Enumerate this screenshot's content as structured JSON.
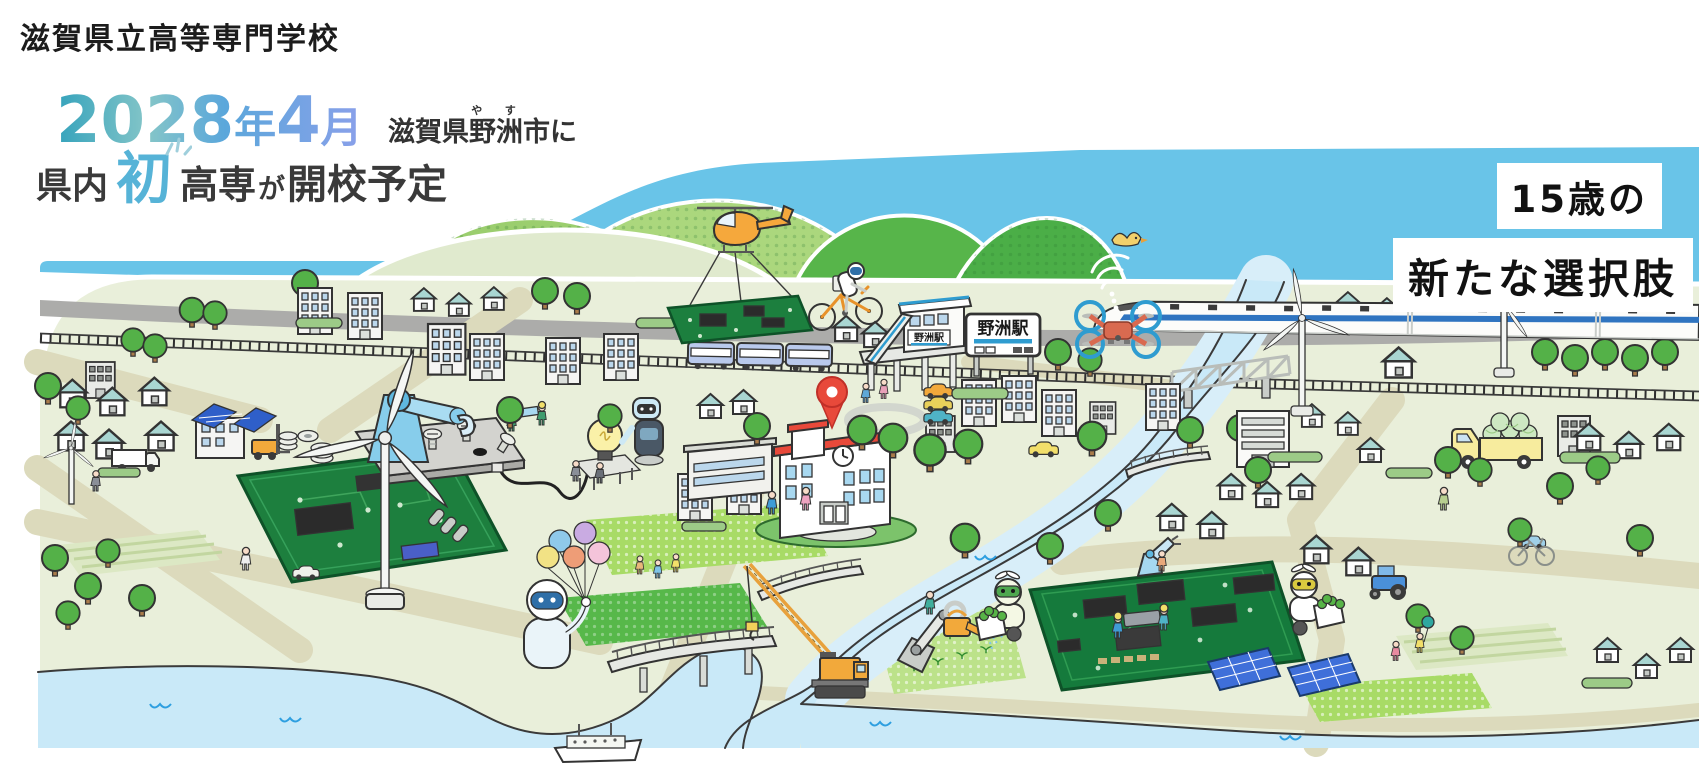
{
  "header": {
    "site_title": "滋賀県立高等専門学校",
    "headline": {
      "date_digits_year": "2028",
      "date_unit_year": "年",
      "date_digit_month": "4",
      "date_unit_month": "月",
      "location_prefix": "滋賀県",
      "location_ruby_base": "野洲",
      "location_ruby_reading": "や す",
      "location_suffix": "市に",
      "line2_prefix": "県内",
      "line2_highlight": "初",
      "line2_word": "高専",
      "line2_particle": "が",
      "line2_rest": "開校予定"
    },
    "tagline_line1": "15歳の",
    "tagline_line2": "新たな選択肢"
  },
  "map": {
    "station_signboard_text": "野洲駅",
    "station_building_sign_text": "野洲駅"
  },
  "palette": {
    "sky": "#69C4E8",
    "land": "#E9EFDA",
    "road": "#DCDABC",
    "gray_track": "#ACACAA",
    "hill_light": "#9BCE6E",
    "hill_mid": "#ABD77D",
    "hill_dark": "#57B54A",
    "hill_pale": "#E0EACE",
    "water": "#C9E9F8",
    "pcb_green": "#1D7F3E",
    "roof_teal": "#A9D6D2",
    "school_red": "#E8493A",
    "pin_red": "#E8493A",
    "crane_orange": "#F2A93B",
    "drone_red": "#D96A50",
    "rotor_blue": "#2F9CD0",
    "shinkansen_stripe": "#2F74C0",
    "date_gradient_start": "#35A3BC",
    "date_gradient_end": "#8AA0EA",
    "hatsu_blue": "#56B3D7"
  },
  "illustration_elements": [
    "sky",
    "hills",
    "land",
    "railway",
    "gray-track",
    "roads",
    "lake",
    "river",
    "riverside-road",
    "pedestrian-bridge",
    "upper-bridge",
    "small-bridge",
    "truss-bridge",
    "ferry",
    "crane",
    "pcb-field-left",
    "pcb-field-right",
    "seedling-field",
    "striped-fields",
    "dotted-fields",
    "school-building",
    "map-pin-icon",
    "yasu-station",
    "station-signboard",
    "warehouse",
    "solar-roof-building",
    "offices",
    "houses",
    "trees",
    "bushes",
    "people",
    "wind-turbine-large",
    "wind-turbine-right-1",
    "wind-turbine-right-2",
    "wind-turbine-small",
    "robot-arm-factory",
    "bolt-plate",
    "nut-stacks",
    "light-bulb",
    "humanoid-robot",
    "balloon-robot",
    "watering-robot-arm",
    "harvest-robot-green",
    "harvest-robot-yellow",
    "pcb-workers",
    "small-pcb-arm",
    "solar-panels",
    "melon-truck",
    "white-truck",
    "forklift",
    "tractor",
    "mini-cars",
    "parked-cars",
    "bicycle",
    "local-train",
    "shinkansen",
    "helicopter",
    "slung-pcb",
    "cycling-robot",
    "drone",
    "wifi-signal-icon",
    "bird"
  ]
}
